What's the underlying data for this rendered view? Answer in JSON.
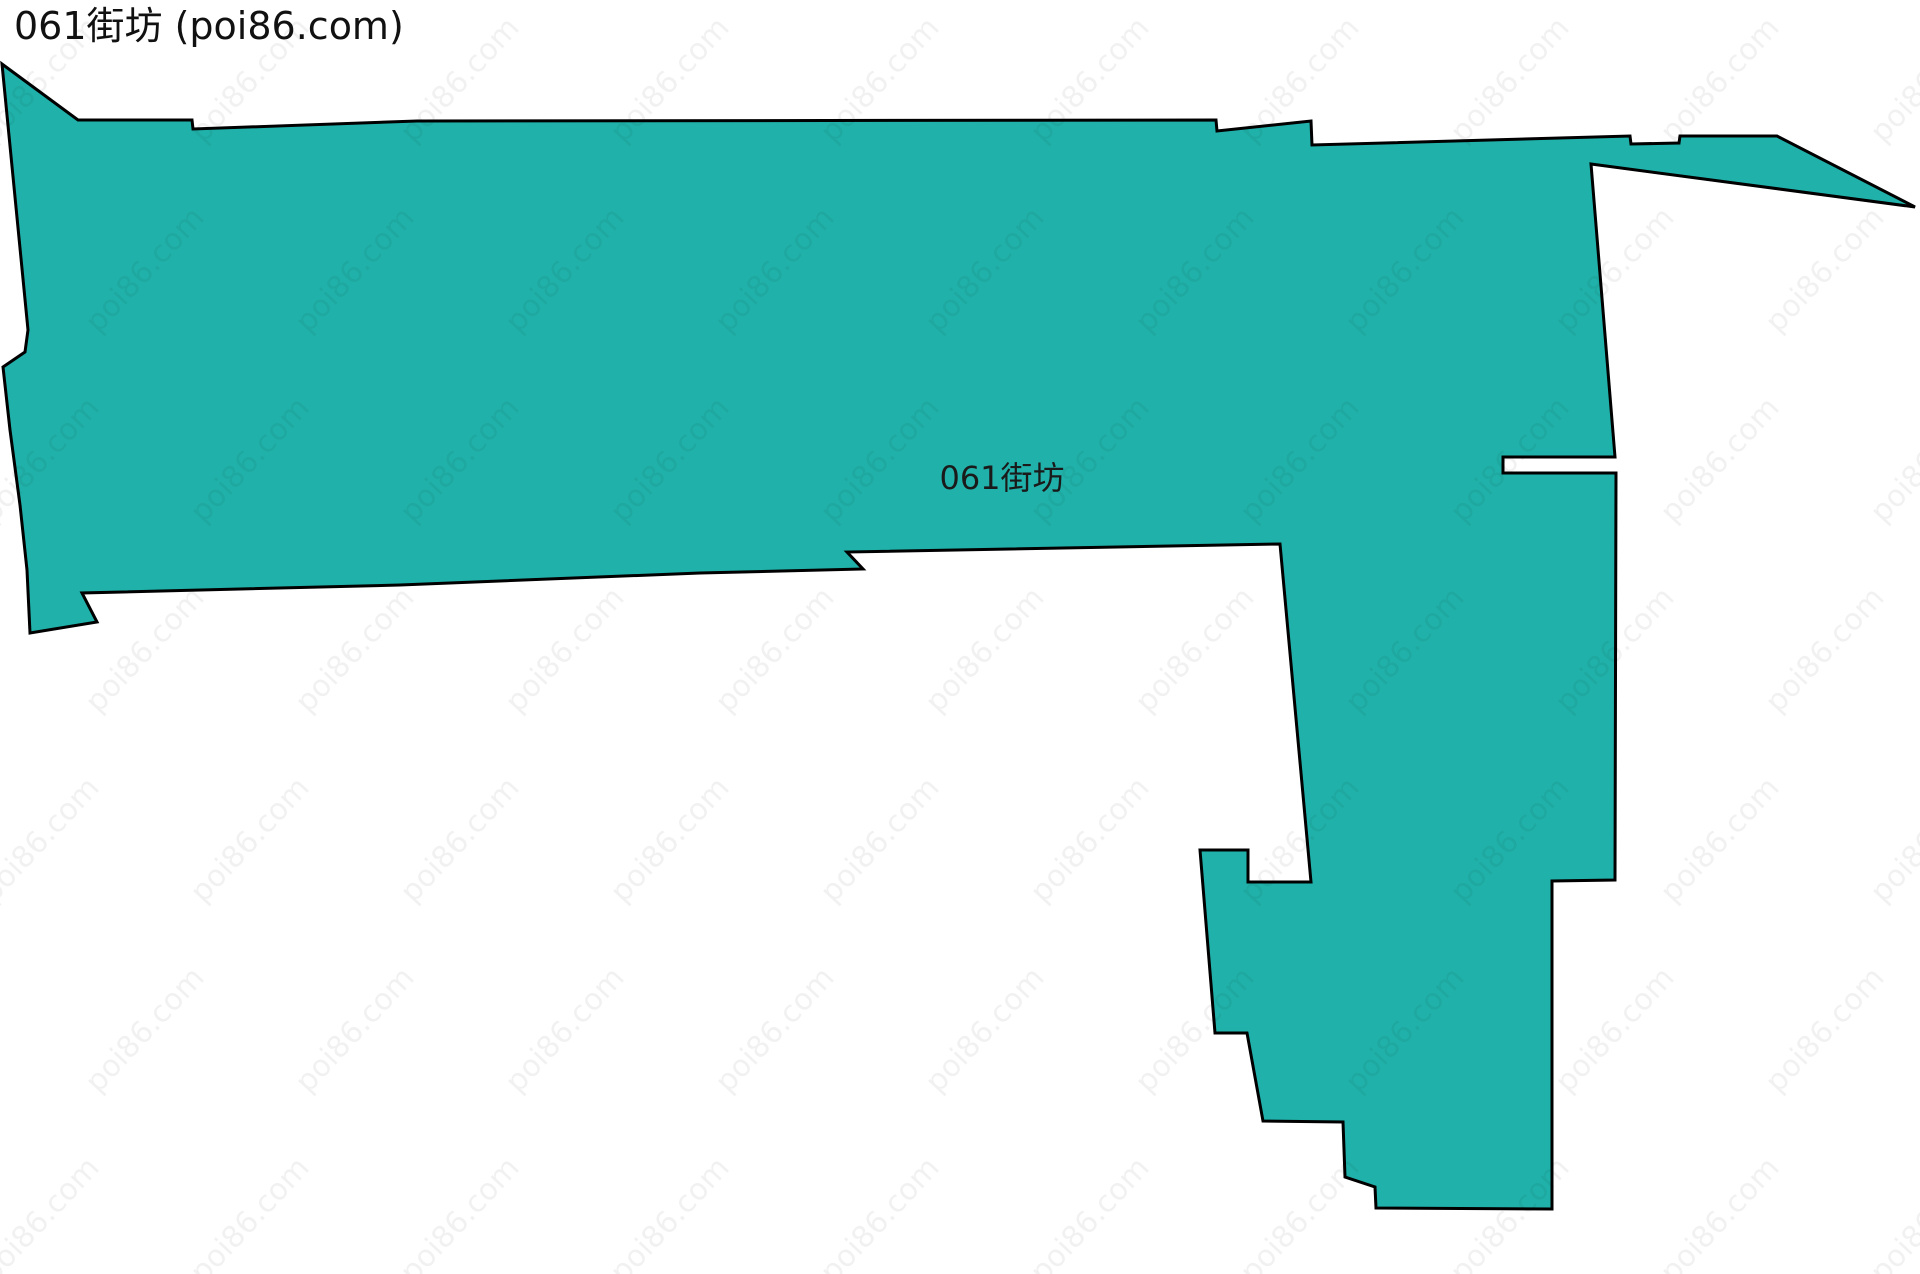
{
  "header": {
    "title": "061街坊 (poi86.com)"
  },
  "map": {
    "background_color": "#ffffff",
    "width": 1920,
    "height": 1274,
    "region": {
      "name": "061街坊",
      "label": "061街坊",
      "label_position": {
        "x": 1002,
        "y": 489
      },
      "label_font_size": 32,
      "label_color": "#1a1a1a",
      "fill_color": "#20b2aa",
      "stroke_color": "#000000",
      "stroke_width": 3,
      "outline_points": [
        [
          2,
          64
        ],
        [
          78,
          120
        ],
        [
          192,
          120
        ],
        [
          193,
          129
        ],
        [
          417,
          121
        ],
        [
          1216,
          120
        ],
        [
          1217,
          131
        ],
        [
          1311,
          121
        ],
        [
          1312,
          145
        ],
        [
          1630,
          136
        ],
        [
          1631,
          144
        ],
        [
          1679,
          143
        ],
        [
          1680,
          136
        ],
        [
          1777,
          136
        ],
        [
          1915,
          207
        ],
        [
          1591,
          164
        ],
        [
          1615,
          457
        ],
        [
          1503,
          457
        ],
        [
          1503,
          473
        ],
        [
          1616,
          473
        ],
        [
          1615,
          880
        ],
        [
          1552,
          881
        ],
        [
          1552,
          1209
        ],
        [
          1376,
          1208
        ],
        [
          1375,
          1187
        ],
        [
          1345,
          1177
        ],
        [
          1343,
          1122
        ],
        [
          1263,
          1121
        ],
        [
          1247,
          1033
        ],
        [
          1215,
          1033
        ],
        [
          1200,
          850
        ],
        [
          1248,
          850
        ],
        [
          1248,
          882
        ],
        [
          1311,
          882
        ],
        [
          1280,
          544
        ],
        [
          847,
          552
        ],
        [
          863,
          569
        ],
        [
          700,
          573
        ],
        [
          400,
          585
        ],
        [
          82,
          593
        ],
        [
          97,
          622
        ],
        [
          30,
          633
        ],
        [
          27,
          570
        ],
        [
          20,
          505
        ],
        [
          10,
          430
        ],
        [
          3,
          367
        ],
        [
          25,
          352
        ],
        [
          28,
          330
        ]
      ]
    }
  },
  "watermark": {
    "text": "poi86.com",
    "color": "rgba(0, 0, 0, 0.055)",
    "font_size": 30,
    "rotation_deg": -47,
    "grid": {
      "x_start": 40,
      "y_start": 80,
      "x_step": 210,
      "y_step": 190,
      "row_offset": 105,
      "x_end": 2040,
      "y_end": 1380
    }
  }
}
